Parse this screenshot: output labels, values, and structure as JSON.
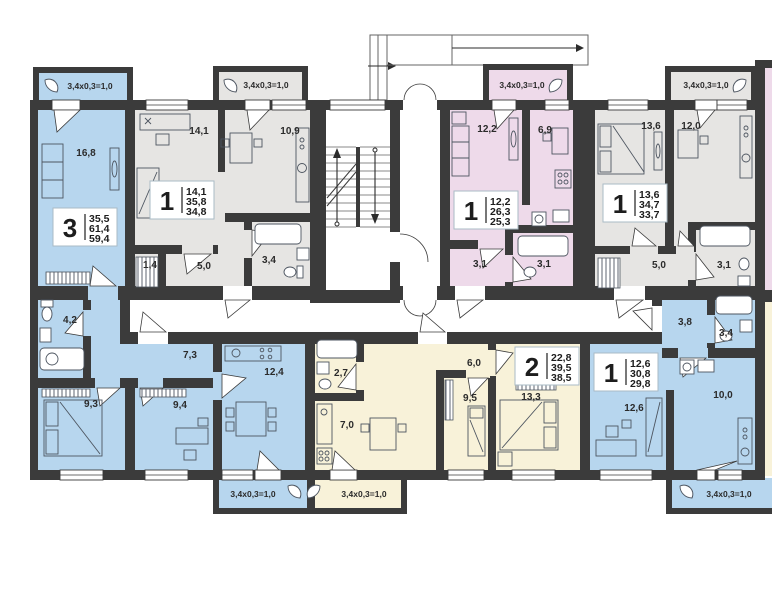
{
  "plan": {
    "balcony_label": "3,4x0,3=1,0",
    "colors": {
      "wall": "#3b3b3b",
      "apartment_blue": "#b7d6ee",
      "apartment_gray": "#e6e5e3",
      "apartment_pink": "#eedaea",
      "apartment_yellow": "#f8f2d9",
      "corridor_white": "#ffffff"
    },
    "apartments": {
      "apt3": {
        "number": "3",
        "areas": [
          "35,5",
          "61,4",
          "59,4"
        ],
        "rooms": {
          "living": "16,8",
          "bath": "4,2",
          "hall": "7,3",
          "bed1": "9,3",
          "bed2": "9,4",
          "kitchen": "12,4"
        }
      },
      "apt1a": {
        "number": "1",
        "areas": [
          "14,1",
          "35,8",
          "34,8"
        ],
        "rooms": {
          "living": "14,1",
          "kitchen": "10,9",
          "hall1": "1,4",
          "hall2": "5,0",
          "bath": "3,4"
        }
      },
      "apt1b": {
        "number": "1",
        "areas": [
          "12,2",
          "26,3",
          "25,3"
        ],
        "rooms": {
          "living": "12,2",
          "kitchen": "6,9",
          "hall": "3,1",
          "bath": "3,1"
        }
      },
      "apt1c": {
        "number": "1",
        "areas": [
          "13,6",
          "34,7",
          "33,7"
        ],
        "rooms": {
          "living": "13,6",
          "bedroom": "12,0",
          "hall": "5,0",
          "bath": "3,1"
        }
      },
      "apt2": {
        "number": "2",
        "areas": [
          "22,8",
          "39,5",
          "38,5"
        ],
        "rooms": {
          "bath": "2,7",
          "kitchen": "7,0",
          "hall": "6,0",
          "bed": "9,5",
          "living": "13,3"
        }
      },
      "apt1d": {
        "number": "1",
        "areas": [
          "12,6",
          "30,8",
          "29,8"
        ],
        "rooms": {
          "hall": "3,8",
          "bath": "3,4",
          "kitchen": "10,0",
          "living": "12,6"
        }
      }
    }
  }
}
